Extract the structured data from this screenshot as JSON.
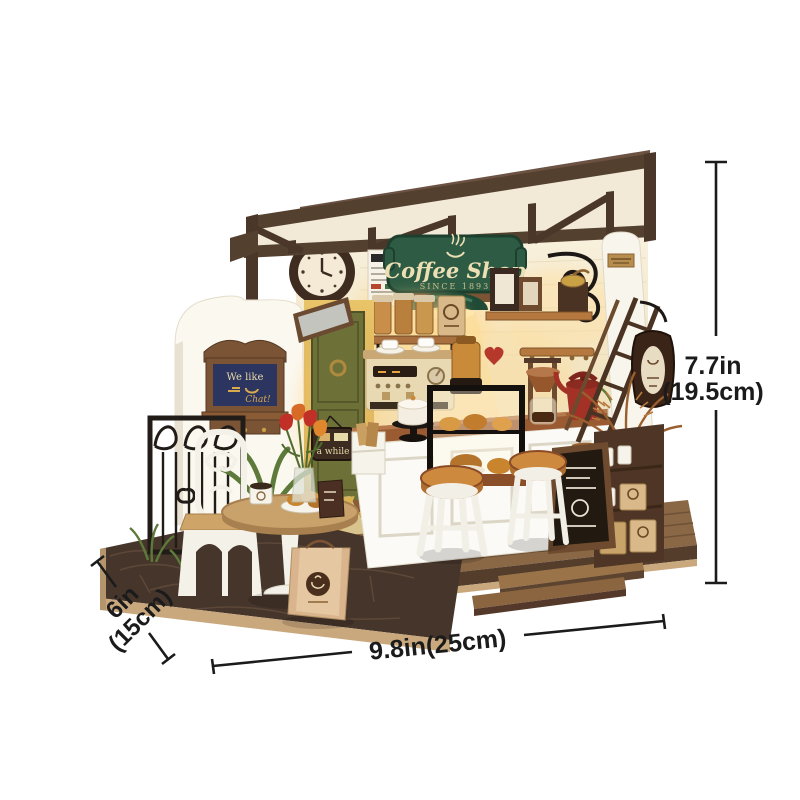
{
  "page": {
    "background": "#ffffff",
    "subject": "miniature coffee shop dollhouse kit product photo with dimension arrows"
  },
  "annotations": {
    "color": "#1b1b1b",
    "height": {
      "value_in": "7.7in",
      "value_cm": "(19.5cm)"
    },
    "depth": {
      "value_in": "6in",
      "value_cm": "(15cm)"
    },
    "width": {
      "value": "9.8in(25cm)"
    }
  },
  "model": {
    "storefront_sign": {
      "title": "Coffee Shop",
      "subtitle": "SINCE 1893",
      "background": "#2d5b43",
      "text_color": "#ecdfb4"
    },
    "notice_board": {
      "line1": "We like",
      "line2": "Chat!"
    },
    "door_sign": {
      "text": "a while"
    },
    "palette": {
      "roof_timber": "#54402f",
      "wall_cream": "#f6eed9",
      "door_olive": "#6d7138",
      "counter_wood": "#9a5b32",
      "counter_white": "#fbfaf6",
      "stool_seat": "#cd8a3f",
      "kettle_red": "#a33126",
      "floor_wood": "#8a6845",
      "patio_stone": "#46352a",
      "base_edge": "#caa87d",
      "iron_black": "#211c18",
      "warm_glow": "#ffd98f",
      "plant_green": "#5d7a3a",
      "dried_fern": "#9a5f2e",
      "terracotta": "#c2604a"
    }
  }
}
